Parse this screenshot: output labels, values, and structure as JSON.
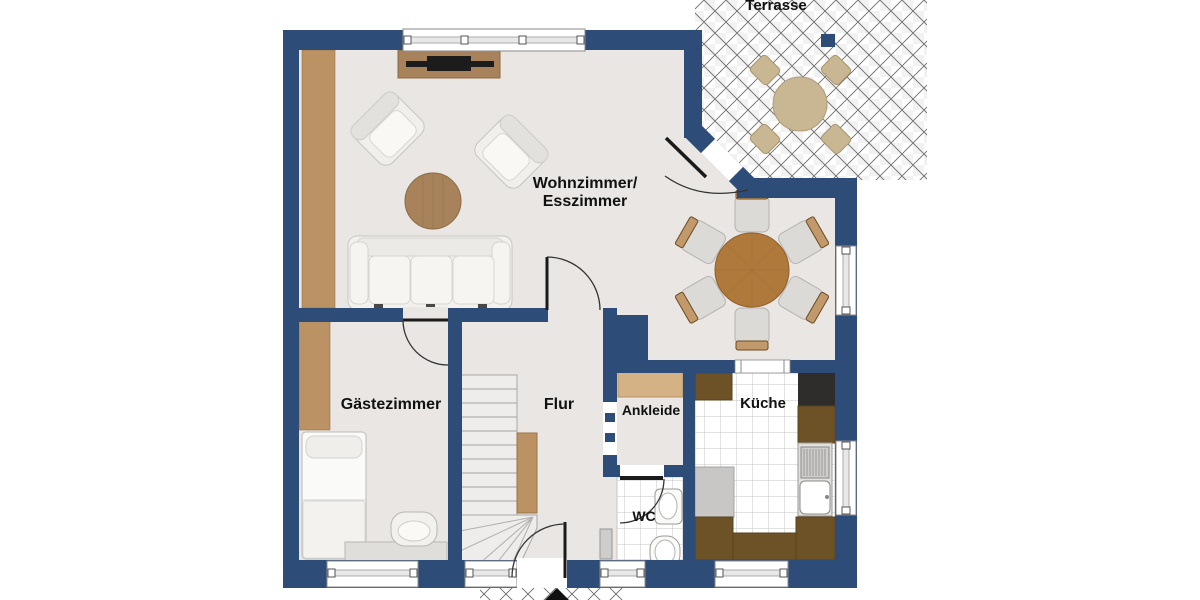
{
  "plan": {
    "labels": {
      "terrasse": "Terrasse",
      "wohnzimmer_line1": "Wohnzimmer/",
      "wohnzimmer_line2": "Esszimmer",
      "gaestezimmer": "Gästezimmer",
      "flur": "Flur",
      "ankleide": "Ankleide",
      "kueche": "Küche",
      "wc": "WC"
    },
    "colors": {
      "wall": "#2d4c78",
      "floor": "#e9e6e3",
      "wood_light": "#bb9263",
      "wood_mid": "#a8825a",
      "table_wood": "#b0793c",
      "counter_dark": "#6e5227",
      "appliance_black": "#2f2d2b",
      "wardrobe_tan": "#d5b285",
      "terrace_furniture": "#c9b693",
      "fixture_white": "#fafaf8",
      "label_text": "#111111"
    }
  }
}
